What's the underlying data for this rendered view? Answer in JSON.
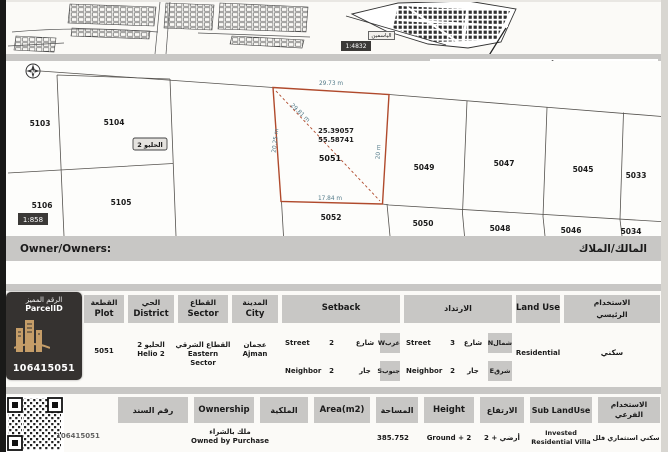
{
  "page": {
    "title": "موقع الأرض / Plot Demarcation"
  },
  "maps": {
    "inset_scale": "1:4832",
    "inset_area_label": "الياسمين",
    "survey_scale": "1:858",
    "district_chip": "الحليو 2",
    "north": "N"
  },
  "survey": {
    "highlight": {
      "number": "5051",
      "latitude": "25.39057",
      "longitude": "55.58741",
      "dim_top": "29.73 m",
      "dim_diagonal": "29.81 m",
      "dim_left": "20.25 m",
      "dim_right": "20 m",
      "dim_bottom": "17.84 m"
    },
    "plots": {
      "p5103": "5103",
      "p5104": "5104",
      "p5105": "5105",
      "p5106": "5106",
      "p5049": "5049",
      "p5047": "5047",
      "p5045": "5045",
      "p5033": "5033",
      "p5052": "5052",
      "p5050": "5050",
      "p5048": "5048",
      "p5046": "5046",
      "p5034": "5034"
    }
  },
  "owner": {
    "label_en": "Owner/Owners:",
    "label_ar": "المالك/الملاك"
  },
  "stamp": {
    "header_ar": "الرقم المميز",
    "header_en": "ParcelID",
    "parcel_id": "106415051"
  },
  "table1": {
    "plot": {
      "h_ar": "القطعة",
      "h_en": "Plot",
      "value": "5051"
    },
    "district": {
      "h_ar": "الحي",
      "h_en": "District",
      "v_ar": "الحليو 2",
      "v_en": "Helio 2"
    },
    "sector": {
      "h_ar": "القطاع",
      "h_en": "Sector",
      "v_ar": "القطاع الشرقي",
      "v_en": "Eastern Sector"
    },
    "city": {
      "h_ar": "المدينة",
      "h_en": "City",
      "v_ar": "عجمان",
      "v_en": "Ajman"
    },
    "setback_w": {
      "header": "Setback",
      "rows": [
        {
          "en": "Street",
          "val": "2",
          "ar": "شارع",
          "dir": "غربW"
        },
        {
          "en": "Neighbor",
          "val": "2",
          "ar": "جار",
          "dir": "جنوبS"
        }
      ]
    },
    "setback_e": {
      "header": "الارتداد",
      "rows": [
        {
          "en": "Street",
          "val": "3",
          "ar": "شارع",
          "dir": "شمالN"
        },
        {
          "en": "Neighbor",
          "val": "2",
          "ar": "جار",
          "dir": "شرقE"
        }
      ]
    },
    "land_use": {
      "h_en": "Land Use",
      "value": "Residential"
    },
    "main_use": {
      "h_ar_1": "الاستخدام",
      "h_ar_2": "الرئيسي",
      "value": "سكني"
    }
  },
  "table2": {
    "deed": {
      "h_ar": "رقم السند",
      "value": ""
    },
    "ownership": {
      "h_en": "Ownership",
      "h_ar": "الملكية",
      "v_ar": "ملك بالشراء",
      "v_en": "Owned by Purchase"
    },
    "area": {
      "h_en": "Area(m2)",
      "h_ar": "المساحة",
      "value": "385.752"
    },
    "height": {
      "h_en": "Height",
      "h_ar": "الارتفاع",
      "v_en": "Ground + 2",
      "v_ar": "أرضي + 2"
    },
    "sub_use": {
      "h_en": "Sub LandUse",
      "h_ar_1": "الاستخدام",
      "h_ar_2": "الفرعي",
      "v_en_1": "Invested",
      "v_en_2": "Residential Villa",
      "v_ar": "سكني استثماري فلل"
    },
    "footer_id": "106415051"
  }
}
